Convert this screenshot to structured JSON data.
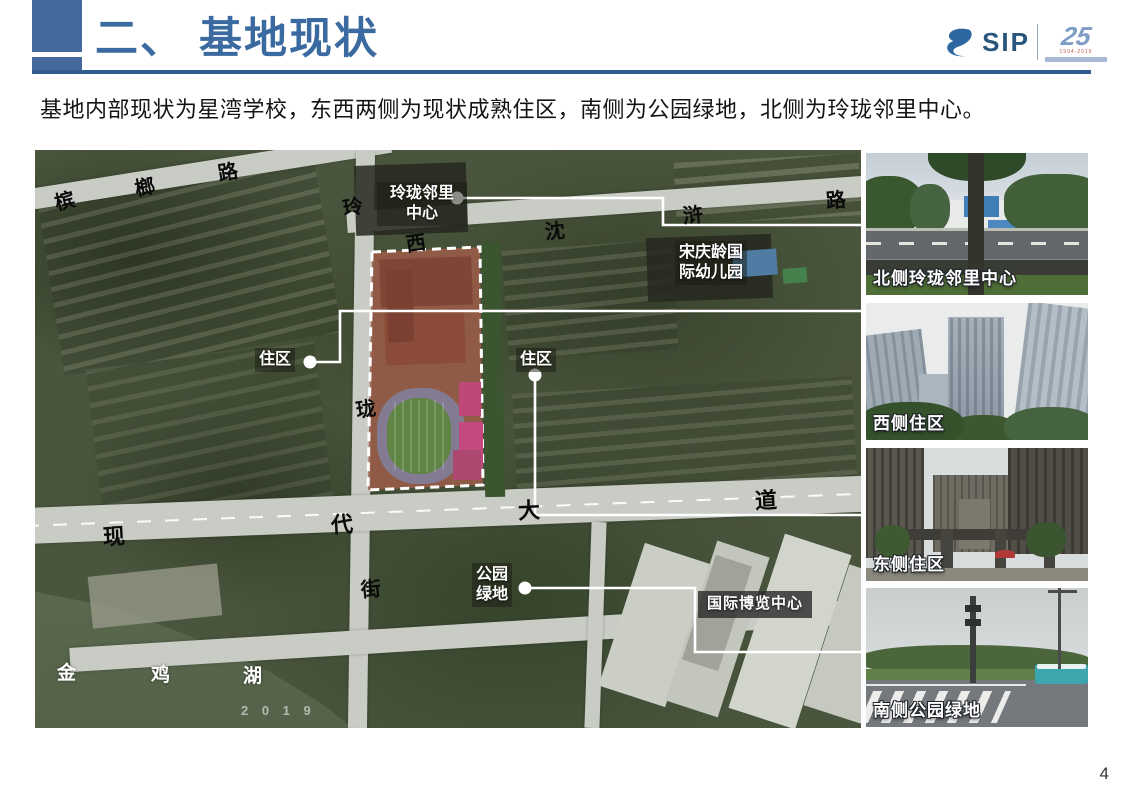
{
  "header": {
    "title": "二、 基地现状"
  },
  "intro": {
    "text": "基地内部现状为星湾学校，东西两侧为现状成熟住区，南侧为公园绿地，北侧为玲珑邻里中心。"
  },
  "logo": {
    "sip": "SIP",
    "anniversary_number": "25",
    "anniversary_years": "1994-2019"
  },
  "footer": {
    "page_number": "4"
  },
  "map": {
    "watermark": {
      "text": "2 0 1 9",
      "x": 206,
      "y": 553
    },
    "road_chars": [
      {
        "t": "槟",
        "x": 20,
        "y": 42,
        "r": -14,
        "s": 20
      },
      {
        "t": "榔",
        "x": 100,
        "y": 28,
        "r": -12,
        "s": 20
      },
      {
        "t": "路",
        "x": 183,
        "y": 13,
        "r": -10,
        "s": 20
      },
      {
        "t": "玲",
        "x": 308,
        "y": 48,
        "r": -10,
        "s": 20
      },
      {
        "t": "西",
        "x": 371,
        "y": 84,
        "r": -8,
        "s": 20
      },
      {
        "t": "沈",
        "x": 510,
        "y": 72,
        "r": -5,
        "s": 20
      },
      {
        "t": "浒",
        "x": 648,
        "y": 56,
        "r": -5,
        "s": 20
      },
      {
        "t": "路",
        "x": 791,
        "y": 41,
        "r": -5,
        "s": 20
      },
      {
        "t": "珑",
        "x": 321,
        "y": 250,
        "r": -8,
        "s": 20
      },
      {
        "t": "街",
        "x": 326,
        "y": 430,
        "r": -5,
        "s": 20
      },
      {
        "t": "现",
        "x": 68,
        "y": 376,
        "r": -3,
        "s": 22
      },
      {
        "t": "代",
        "x": 296,
        "y": 364,
        "r": -3,
        "s": 22
      },
      {
        "t": "大",
        "x": 483,
        "y": 350,
        "r": -3,
        "s": 22
      },
      {
        "t": "道",
        "x": 720,
        "y": 340,
        "r": -3,
        "s": 22
      },
      {
        "t": "金",
        "x": 22,
        "y": 514,
        "r": 0,
        "s": 19,
        "c": "w"
      },
      {
        "t": "鸡",
        "x": 116,
        "y": 516,
        "r": 0,
        "s": 19,
        "c": "w"
      },
      {
        "t": "湖",
        "x": 208,
        "y": 517,
        "r": 0,
        "s": 19,
        "c": "w"
      }
    ],
    "labels": [
      {
        "id": "linglong-neighborhood-center",
        "lines": [
          "玲珑邻里",
          "中心"
        ],
        "x": 342,
        "y": 32,
        "w": 82,
        "fs": 16,
        "align": "center"
      },
      {
        "id": "songqingling-kindergarten",
        "lines": [
          "宋庆龄国",
          "际幼儿园"
        ],
        "x": 640,
        "y": 91,
        "fs": 16,
        "align": "left"
      },
      {
        "id": "residential-west",
        "lines": [
          "住区"
        ],
        "x": 220,
        "y": 198,
        "fs": 16,
        "align": "left"
      },
      {
        "id": "residential-east",
        "lines": [
          "住区"
        ],
        "x": 481,
        "y": 198,
        "fs": 16,
        "align": "left"
      },
      {
        "id": "park-green",
        "lines": [
          "公园",
          "绿地"
        ],
        "x": 437,
        "y": 413,
        "fs": 16,
        "align": "center"
      },
      {
        "id": "expo-center",
        "lines": [
          "国际博览中心"
        ],
        "x": 663,
        "y": 441,
        "fs": 15,
        "align": "left",
        "boxed": true
      }
    ],
    "leaders": [
      {
        "id": "north-to-photo1",
        "dot": [
          422,
          48
        ],
        "path": "M 422 48 H 628 V 75 H 826"
      },
      {
        "id": "west-to-photo2",
        "dot": [
          275,
          212
        ],
        "path": "M 275 212 H 305 V 161 H 826"
      },
      {
        "id": "east-to-photo3",
        "dot": [
          500,
          225
        ],
        "path": "M 500 225 V 365 H 826"
      },
      {
        "id": "south-to-photo4",
        "dot": [
          490,
          438
        ],
        "path": "M 490 438 H 660 V 502 H 826"
      }
    ]
  },
  "photos": [
    {
      "caption": "北侧玲珑邻里中心"
    },
    {
      "caption": "西侧住区"
    },
    {
      "caption": "东侧住区"
    },
    {
      "caption": "南侧公园绿地"
    }
  ]
}
